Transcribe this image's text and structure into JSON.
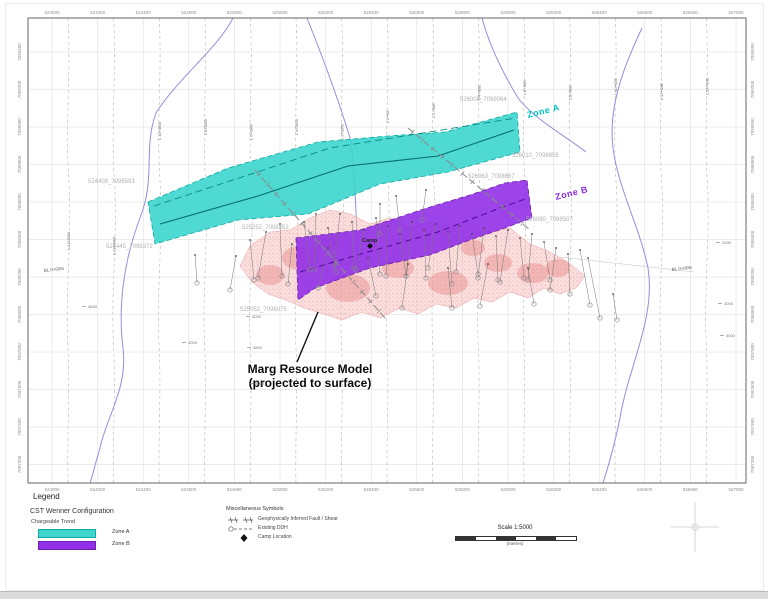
{
  "colors": {
    "zone_a": "#3fd6ce",
    "zone_b": "#9130e8",
    "resource": "#f4b6b6",
    "stream": "#8f90dc"
  },
  "map": {
    "axis": {
      "eastings": [
        "524000",
        "524200",
        "524400",
        "524600",
        "524800",
        "525000",
        "525200",
        "525400",
        "525600",
        "525800",
        "526000",
        "526200",
        "526400",
        "526600",
        "526800",
        "527000"
      ],
      "northings": [
        "7099400",
        "7099200",
        "7099000",
        "7098800",
        "7098600",
        "7098400",
        "7098200",
        "7098000",
        "7097800",
        "7097600",
        "7097400",
        "7097200"
      ]
    },
    "survey_lines": {
      "labels": [
        "L 14+00W",
        "L 12+00W",
        "L 10+00W",
        "L 8+00W",
        "L 6+00W",
        "L 4+00W",
        "L 2+00W",
        "L 0+00",
        "L 2+00E",
        "L 4+00E",
        "L 6+00E",
        "L 8+00E",
        "L 10+00E",
        "L 12+00E",
        "L 14+00E"
      ],
      "label_y": [
        250,
        255,
        140,
        135,
        140,
        135,
        140,
        123,
        118,
        100,
        95,
        100,
        95,
        100,
        95
      ]
    },
    "streams": {
      "s1": "M 233,18 C 218,48 178,78 156,113 C 143,148 156,178 140,218 C 123,263 118,308 123,348 C 128,388 106,418 100,448 C 94,468 92,478 90,483",
      "s2": "M 307,18 C 323,58 338,98 350,138 C 355,168 356,218 358,258",
      "s3": "M 482,18 C 490,48 506,78 518,98 C 533,118 568,138 586,152",
      "s4": "M 642,28 C 623,68 608,108 613,148 C 618,188 640,228 648,268 C 656,318 628,368 620,418 C 613,453 606,473 603,483"
    },
    "resource_model": {
      "outline": "M 240,266 L 250,246 L 270,232 L 290,230 L 310,218 L 330,210 L 350,214 L 370,224 L 390,218 L 410,228 L 430,222 L 450,228 L 470,224 L 490,232 L 510,228 L 530,244 L 550,252 L 568,262 L 585,276 L 576,288 L 560,294 L 544,288 L 528,298 L 510,292 L 492,302 L 474,298 L 456,308 L 436,304 L 418,314 L 400,308 L 380,318 L 362,312 L 342,320 L 324,314 L 304,308 L 286,300 L 268,294 L 252,282 Z",
      "patches": [
        [
          300,
          258,
          18,
          12
        ],
        [
          348,
          288,
          22,
          14
        ],
        [
          398,
          268,
          16,
          10
        ],
        [
          448,
          283,
          20,
          12
        ],
        [
          498,
          263,
          14,
          9
        ],
        [
          533,
          273,
          16,
          10
        ],
        [
          328,
          243,
          12,
          8
        ],
        [
          473,
          248,
          12,
          8
        ],
        [
          558,
          268,
          12,
          9
        ],
        [
          270,
          275,
          14,
          10
        ]
      ],
      "annotation_line1": "Marg Resource Model",
      "annotation_line2": "(projected to surface)"
    },
    "zones": {
      "a": {
        "label": "Zone A",
        "outline": "M 148,202 L 228,168 L 318,142 L 388,136 L 445,132 L 517,112 L 520,152 L 448,172 L 380,184 L 308,214 L 238,220 L 155,244 Z",
        "centerline": "M 160,224 L 258,196 L 348,166 L 438,156 L 514,130",
        "trendline": "M 154,206 L 330,148 L 516,118"
      },
      "b": {
        "label": "Zone B",
        "outline": "M 296,238 L 360,230 L 430,207 L 470,195 L 505,183 L 527,180 L 532,218 L 505,228 L 470,240 L 430,255 L 370,268 L 315,288 L 298,300 Z",
        "centerline": "M 300,272 L 368,252 L 438,232 L 500,208 L 528,198"
      }
    },
    "faults": [
      [
        255,
        170,
        385,
        318
      ],
      [
        408,
        128,
        530,
        230
      ]
    ],
    "drillholes": [
      [
        236,
        256,
        -6,
        34
      ],
      [
        250,
        240,
        4,
        40
      ],
      [
        266,
        232,
        -8,
        46
      ],
      [
        280,
        224,
        2,
        52
      ],
      [
        292,
        244,
        -4,
        40
      ],
      [
        304,
        222,
        6,
        48
      ],
      [
        316,
        214,
        -2,
        56
      ],
      [
        328,
        228,
        8,
        44
      ],
      [
        340,
        214,
        -6,
        52
      ],
      [
        352,
        222,
        2,
        46
      ],
      [
        364,
        230,
        -8,
        40
      ],
      [
        376,
        218,
        4,
        56
      ],
      [
        388,
        226,
        -2,
        50
      ],
      [
        400,
        234,
        6,
        42
      ],
      [
        412,
        222,
        -6,
        54
      ],
      [
        424,
        230,
        2,
        48
      ],
      [
        436,
        224,
        -8,
        44
      ],
      [
        448,
        232,
        4,
        52
      ],
      [
        460,
        226,
        -4,
        46
      ],
      [
        472,
        234,
        6,
        40
      ],
      [
        484,
        228,
        -6,
        50
      ],
      [
        496,
        236,
        2,
        44
      ],
      [
        508,
        230,
        -8,
        52
      ],
      [
        520,
        238,
        4,
        40
      ],
      [
        532,
        234,
        -4,
        46
      ],
      [
        544,
        242,
        6,
        38
      ],
      [
        556,
        248,
        -6,
        42
      ],
      [
        568,
        254,
        2,
        40
      ],
      [
        328,
        248,
        -10,
        40
      ],
      [
        368,
        258,
        8,
        38
      ],
      [
        408,
        264,
        -6,
        44
      ],
      [
        448,
        268,
        4,
        40
      ],
      [
        488,
        264,
        -8,
        42
      ],
      [
        528,
        268,
        6,
        36
      ],
      [
        580,
        250,
        10,
        55
      ],
      [
        588,
        258,
        12,
        60
      ],
      [
        380,
        204,
        0,
        30
      ],
      [
        396,
        196,
        4,
        34
      ],
      [
        426,
        190,
        -4,
        30
      ],
      [
        195,
        255,
        2,
        28
      ],
      [
        613,
        294,
        4,
        26
      ]
    ],
    "collar_labels": [
      {
        "t": "524408_7098593",
        "x": 88,
        "y": 183
      },
      {
        "t": "524445_7098372",
        "x": 106,
        "y": 248
      },
      {
        "t": "525052_7098352",
        "x": 242,
        "y": 229
      },
      {
        "t": "525052_7098075",
        "x": 240,
        "y": 311
      },
      {
        "t": "526008_7099064",
        "x": 460,
        "y": 101
      },
      {
        "t": "526010_7098858",
        "x": 512,
        "y": 157
      },
      {
        "t": "526063_7098667",
        "x": 468,
        "y": 178
      },
      {
        "t": "526080_7098507",
        "x": 526,
        "y": 221
      }
    ],
    "station_labels": [
      {
        "t": "4000",
        "x": 88,
        "y": 308
      },
      {
        "t": "4000",
        "x": 188,
        "y": 344
      },
      {
        "t": "4000",
        "x": 252,
        "y": 318
      },
      {
        "t": "4500",
        "x": 253,
        "y": 349
      },
      {
        "t": "5000",
        "x": 255,
        "y": 385
      },
      {
        "t": "2000",
        "x": 722,
        "y": 244
      },
      {
        "t": "3000",
        "x": 724,
        "y": 305
      },
      {
        "t": "4000",
        "x": 726,
        "y": 337
      }
    ],
    "camp": {
      "label": "Camp"
    },
    "baseline_label": "BL 0+00N"
  },
  "legend": {
    "title": "Legend",
    "config_title": "CST Wenner Configuration",
    "subtitle": "Chargeable Trend",
    "zone_a": "Zone A",
    "zone_b": "Zone B",
    "misc_title": "Miscellaneous Symbols",
    "fault_label": "Geophysically Inferred Fault / Shear",
    "ddh_label": "Existing DDH",
    "camp_label": "Camp Location"
  },
  "scalebar": {
    "title": "Scale 1:5000",
    "units": "(metres)"
  }
}
